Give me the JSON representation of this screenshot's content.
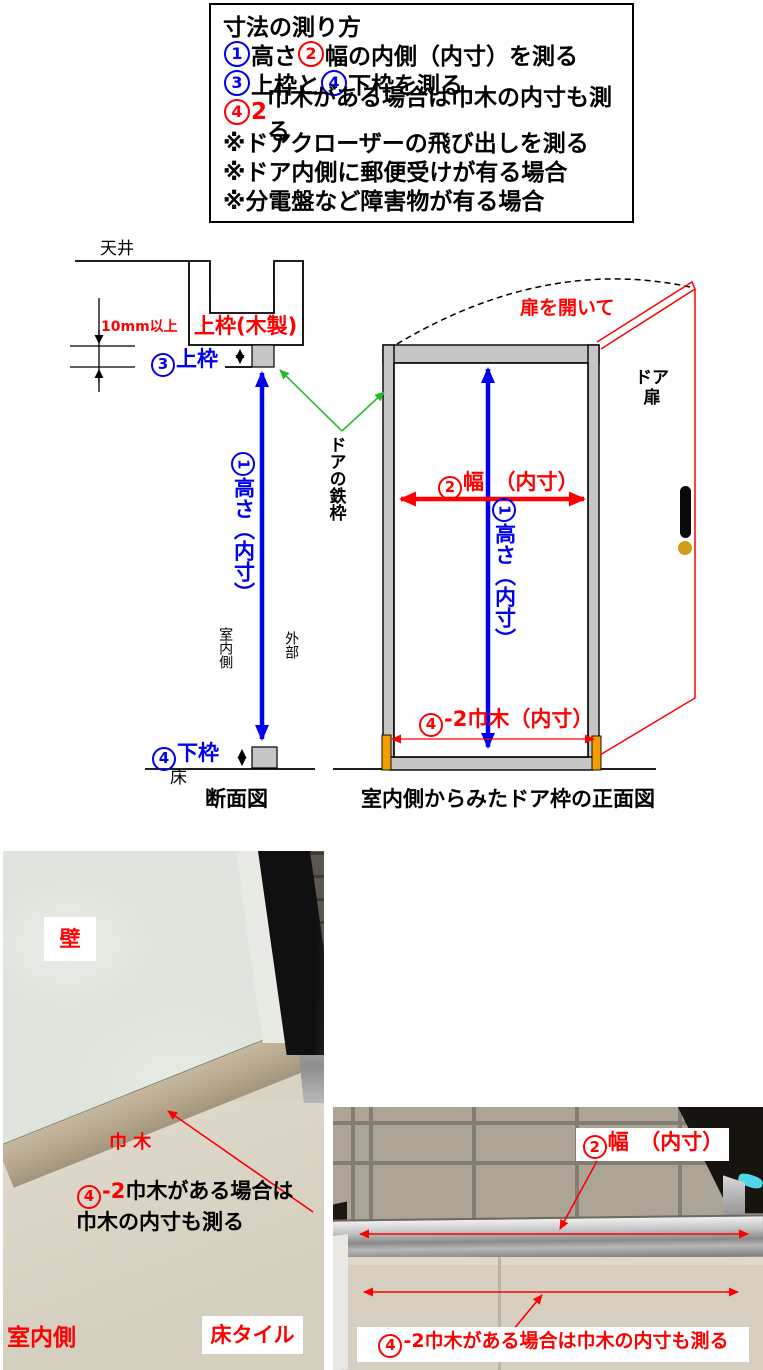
{
  "colors": {
    "blue": "#0000f0",
    "red": "#ff0000",
    "green_arrow": "#2db92d",
    "frame_gray": "#c6c6c6",
    "baseboard_orange": "#f59d00",
    "knob_gold": "#d29e18"
  },
  "instruction_box": {
    "lines": [
      [
        {
          "t": "寸法の測り方",
          "c": "black"
        }
      ],
      [
        {
          "n": "1",
          "c": "blue"
        },
        {
          "t": "高さ",
          "c": "black"
        },
        {
          "n": "2",
          "c": "red"
        },
        {
          "t": "幅の内側（内寸）を測る",
          "c": "black"
        }
      ],
      [
        {
          "n": "3",
          "c": "blue"
        },
        {
          "t": "上枠と",
          "c": "black"
        },
        {
          "n": "4",
          "c": "blue"
        },
        {
          "t": "下枠を測る",
          "c": "black"
        }
      ],
      [
        {
          "n": "4",
          "c": "red"
        },
        {
          "t": "2",
          "c": "red"
        },
        {
          "t": "巾木がある場合は巾木の内寸も測る",
          "c": "black"
        }
      ],
      [
        {
          "t": "※ドアクローザーの飛び出しを測る",
          "c": "black"
        }
      ],
      [
        {
          "t": "※ドア内側に郵便受けが有る場合",
          "c": "black"
        }
      ],
      [
        {
          "t": "※分電盤など障害物が有る場合",
          "c": "black"
        }
      ]
    ]
  },
  "section_view": {
    "ceiling": "天井",
    "min_gap": "10mm以上",
    "upper_frame_wood": "上枠(木製)",
    "upper_frame": [
      {
        "n": "3",
        "c": "blue"
      },
      {
        "t": "上枠",
        "c": "blue"
      }
    ],
    "door_steel_frame": "ドアの鉄枠",
    "height_label": [
      {
        "n": "1",
        "c": "blue"
      },
      {
        "t": "高さ（内寸）",
        "c": "blue"
      }
    ],
    "indoor_side": "室内側",
    "outside": "外部",
    "lower_frame": [
      {
        "n": "4",
        "c": "blue"
      },
      {
        "t": "下枠",
        "c": "blue"
      }
    ],
    "floor": "床",
    "caption": "断面図"
  },
  "front_view": {
    "open_door": "扉を開いて",
    "door_leaf_line1": "ドア",
    "door_leaf_line2": "扉",
    "width_label": [
      {
        "n": "2",
        "c": "red"
      },
      {
        "t": "幅　（内寸）",
        "c": "red"
      }
    ],
    "height_label": [
      {
        "n": "1",
        "c": "blue"
      },
      {
        "t": "高さ（内寸）",
        "c": "blue"
      }
    ],
    "baseboard_width": [
      {
        "n": "4",
        "c": "red"
      },
      {
        "t": "-2巾木（内寸）",
        "c": "red"
      }
    ],
    "caption": "室内側からみたドア枠の正面図"
  },
  "photo_left": {
    "wall": "壁",
    "baseboard": "巾 木",
    "note_line1": [
      {
        "n": "4",
        "c": "red"
      },
      {
        "t": "-2",
        "c": "red"
      },
      {
        "t": "巾木がある場合は",
        "c": "black"
      }
    ],
    "note_line2": [
      {
        "t": "巾木の内寸も測る",
        "c": "black"
      }
    ],
    "indoor_side": "室内側",
    "floor_tile": "床タイル"
  },
  "photo_right": {
    "width_label": [
      {
        "n": "2",
        "c": "red"
      },
      {
        "t": "幅　（内寸）",
        "c": "red"
      }
    ],
    "note": [
      {
        "n": "4",
        "c": "red"
      },
      {
        "t": "-2巾木がある場合は巾木の内寸も測る",
        "c": "red"
      }
    ]
  }
}
